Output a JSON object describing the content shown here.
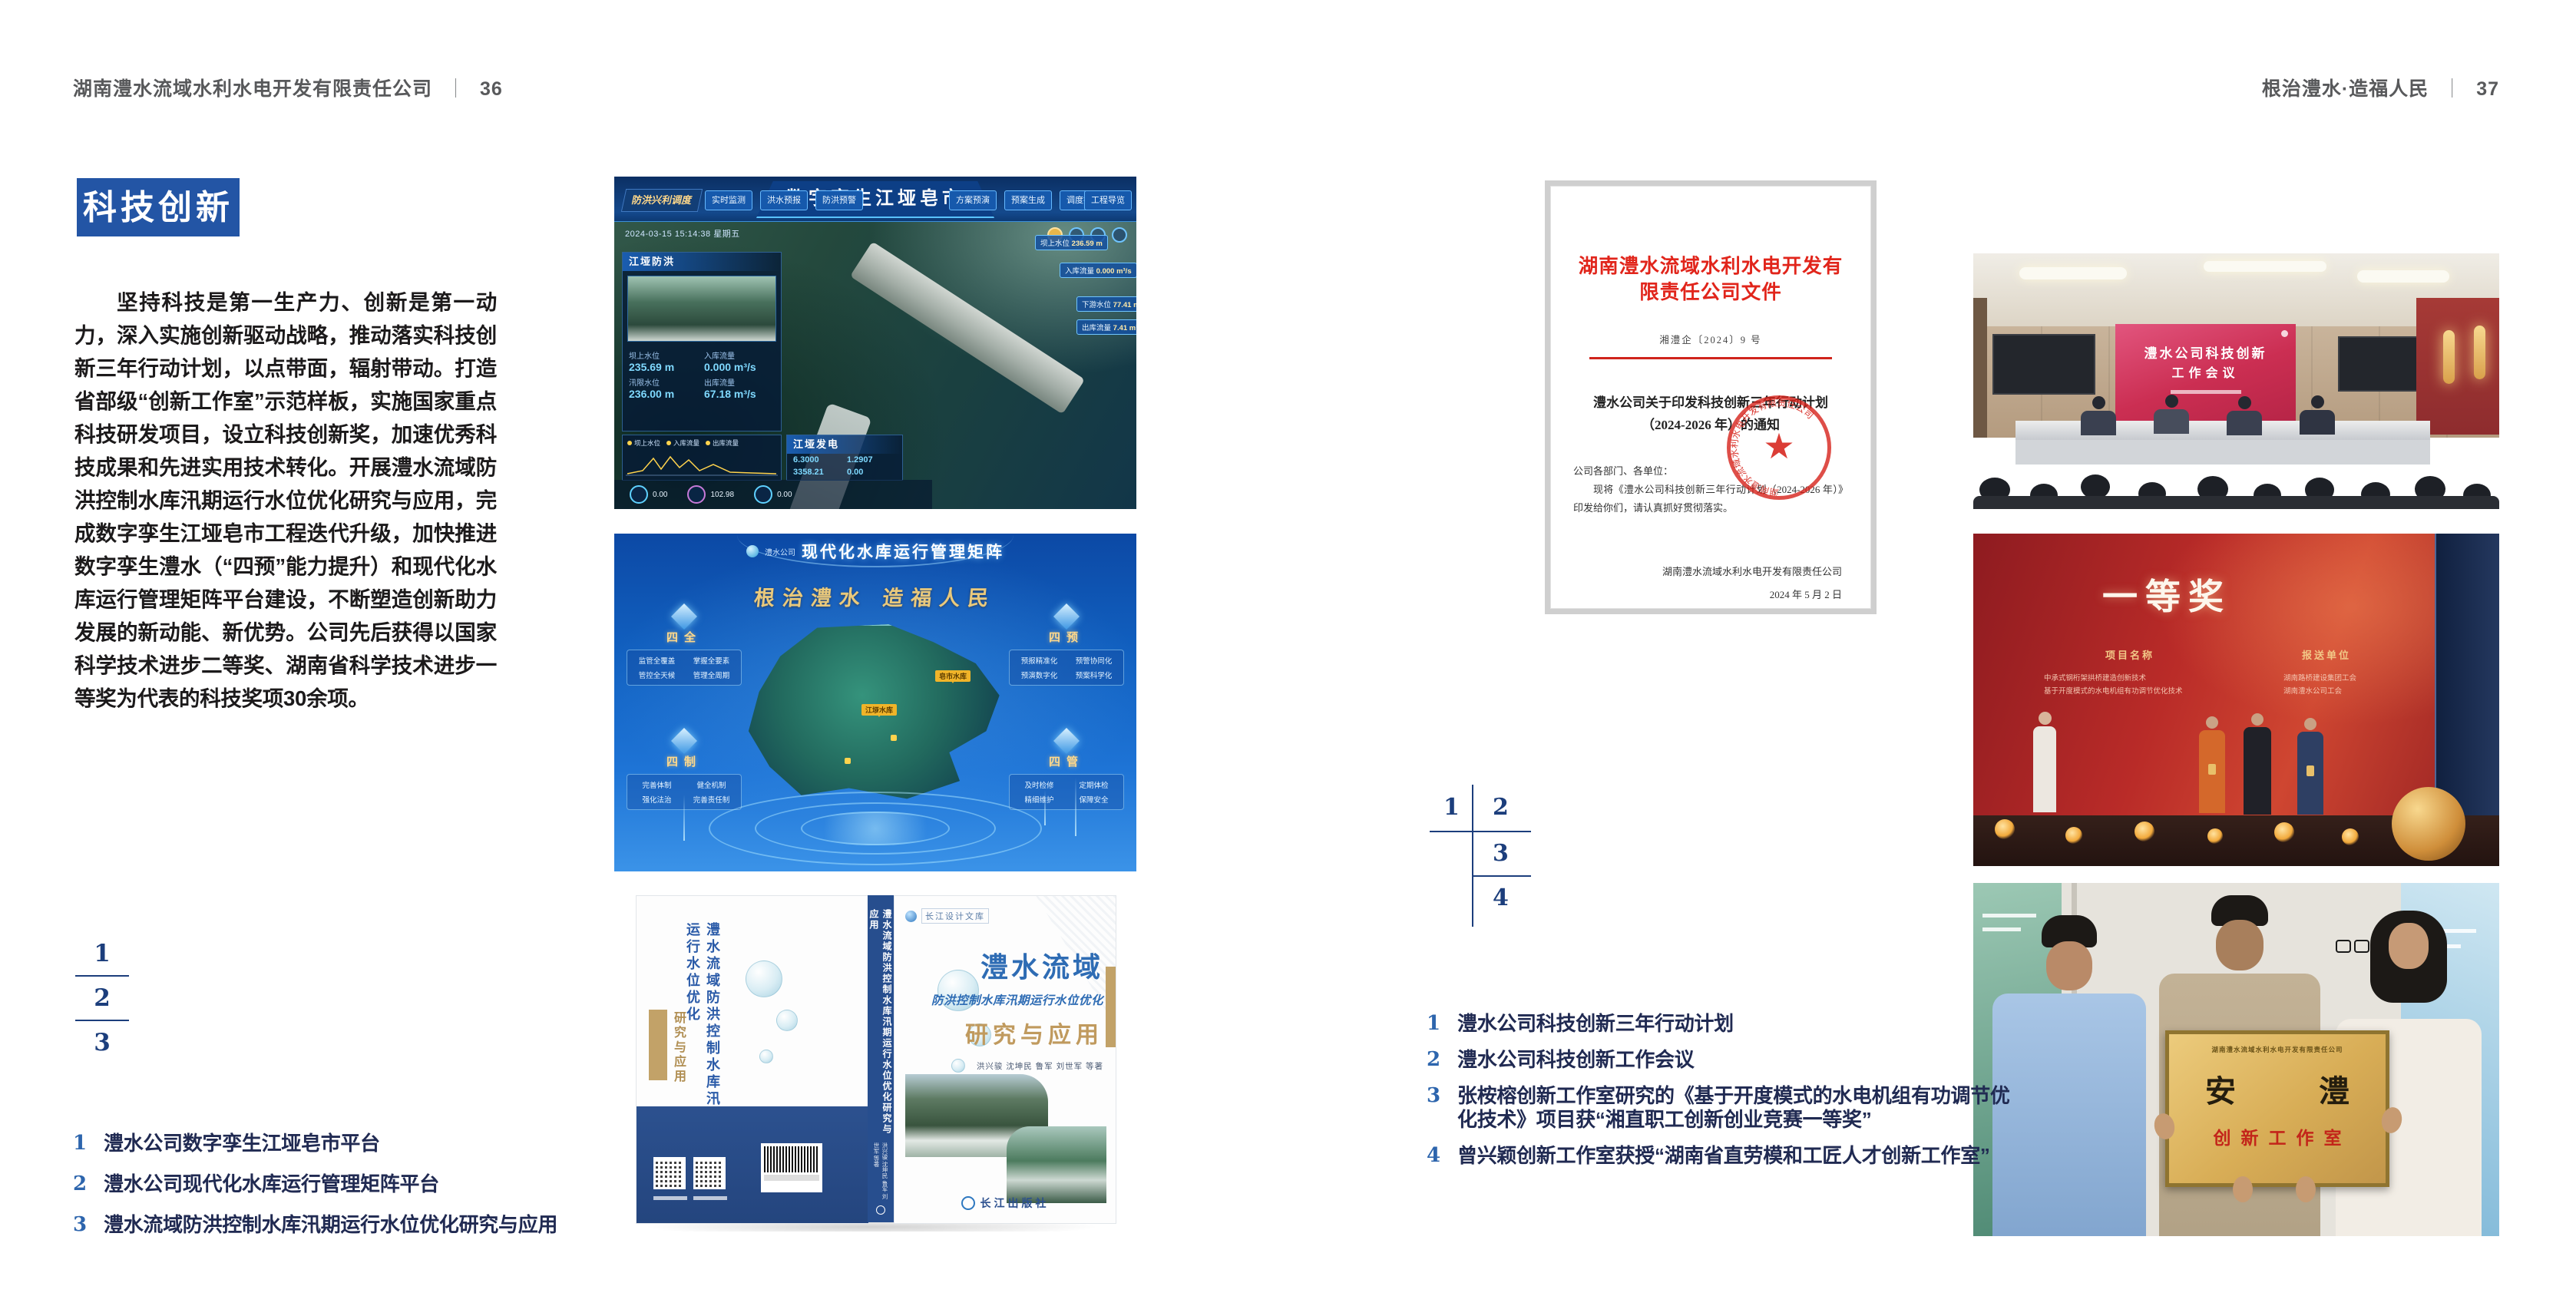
{
  "ui": {
    "separator": "｜"
  },
  "colors": {
    "badge_blue": "#2355a5",
    "figure_number_blue": "#1c3e7c",
    "caption_number_blue": "#2d65ad",
    "caption_text_navy": "#202a52",
    "doc_red": "#e1251b",
    "award_red": "#b92b28",
    "plaque_gold": "#d9b262"
  },
  "icons": {
    "seal_star": "★"
  },
  "page_left": {
    "header": "湖南澧水流域水利水电开发有限责任公司",
    "page_no": "36",
    "section_badge": "科技创新",
    "body": "坚持科技是第一生产力、创新是第一动力，深入实施创新驱动战略，推动落实科技创新三年行动计划，以点带面，辐射带动。打造省部级“创新工作室”示范样板，实施国家重点科技研发项目，设立科技创新奖，加速优秀科技成果和先进实用技术转化。开展澧水流域防洪控制水库汛期运行水位优化研究与应用，完成数字孪生江垭皂市工程迭代升级，加快推进数字孪生澧水（“四预”能力提升）和现代化水库运行管理矩阵平台建设，不断塑造创新助力发展的新动能、新优势。公司先后获得以国家科学技术进步二等奖、湖南省科学技术进步一等奖为代表的科技奖项30余项。",
    "figure_numbers": [
      "1",
      "2",
      "3"
    ],
    "captions": [
      {
        "num": "1",
        "text": "澧水公司数字孪生江垭皂市平台"
      },
      {
        "num": "2",
        "text": "澧水公司现代化水库运行管理矩阵平台"
      },
      {
        "num": "3",
        "text": "澧水流域防洪控制水库汛期运行水位优化研究与应用"
      }
    ]
  },
  "page_right": {
    "header": "根治澧水·造福人民",
    "page_no": "37",
    "figure_numbers": [
      "1",
      "2",
      "3",
      "4"
    ],
    "captions": [
      {
        "num": "1",
        "text": "澧水公司科技创新三年行动计划"
      },
      {
        "num": "2",
        "text": "澧水公司科技创新工作会议"
      },
      {
        "num": "3",
        "text": "张桉榕创新工作室研究的《基于开度模式的水电机组有功调节优化技术》项目获“湘直职工创新创业竞赛一等奖”"
      },
      {
        "num": "4",
        "text": "曾兴颖创新工作室获授“湖南省直劳模和工匠人才创新工作室”"
      }
    ]
  },
  "fig_digital_twin": {
    "title": "数字孪生江垭皂市",
    "tab": "防洪兴利调度",
    "menus_left": [
      "实时监测",
      "洪水预报",
      "防洪预警"
    ],
    "menus_right": [
      "方案预演",
      "预案生成",
      "调度执行",
      "工程导览"
    ],
    "timestamp": "2024-03-15 15:14:38 星期五",
    "panel_flood": {
      "title": "江垭防洪",
      "stats": [
        {
          "label": "坝上水位",
          "value": "235.69 m"
        },
        {
          "label": "入库流量",
          "value": "0.000 m³/s"
        },
        {
          "label": "汛限水位",
          "value": "236.00 m"
        },
        {
          "label": "出库流量",
          "value": "67.18 m³/s"
        }
      ]
    },
    "chart_legend": [
      "坝上水位",
      "入库流量",
      "出库流量"
    ],
    "panel_power": {
      "title": "江垭发电",
      "values": [
        "6.3000",
        "1.2907",
        "3358.21",
        "0.00"
      ]
    },
    "callouts": [
      {
        "label": "坝上水位",
        "value": "236.59 m"
      },
      {
        "label": "入库流量",
        "value": "0.000 m³/s"
      },
      {
        "label": "下游水位",
        "value": "77.41 m"
      },
      {
        "label": "出库流量",
        "value": "7.41 m³/s"
      }
    ],
    "gauge_values": [
      "0.00",
      "102.98",
      "0.00"
    ]
  },
  "fig_matrix": {
    "logo_text": "澧水公司",
    "header": "现代化水库运行管理矩阵",
    "slogan": "根治澧水 造福人民",
    "markers": [
      "皂市水库",
      "江垭水库"
    ],
    "nodes": [
      {
        "title": "四全",
        "items": [
          "监管全覆盖",
          "掌握全要素",
          "管控全天候",
          "管理全周期"
        ]
      },
      {
        "title": "四预",
        "items": [
          "预报精准化",
          "预警协同化",
          "预演数字化",
          "预案科学化"
        ]
      },
      {
        "title": "四制",
        "items": [
          "完善体制",
          "健全机制",
          "强化法治",
          "完善责任制"
        ]
      },
      {
        "title": "四管",
        "items": [
          "及时检修",
          "定期体检",
          "精细维护",
          "保障安全"
        ]
      }
    ]
  },
  "fig_book": {
    "library": "长江设计文库",
    "title_region": "澧水流域",
    "title_sub": "防洪控制水库汛期运行水位优化",
    "title_main": "研究与应用",
    "authors": "洪兴骏 沈坤民 鲁军 刘世军 等著",
    "spine": "澧水流域防洪控制水库汛期运行水位优化研究与应用",
    "spine_authors": "洪兴骏 沈坤民 鲁军 刘世军 等著",
    "back_title": "澧水流域防洪控制水库汛期运行水位优化",
    "back_sub": "研究与应用",
    "publisher": "长江出版社"
  },
  "fig_document": {
    "letterhead": "湖南澧水流域水利水电开发有限责任公司文件",
    "doc_no": "湘澧企〔2024〕9 号",
    "title_line1": "澧水公司关于印发科技创新三年行动计划",
    "title_line2": "（2024-2026 年）的通知",
    "salutation": "公司各部门、各单位：",
    "body": "现将《澧水公司科技创新三年行动计划（2024-2026 年）》印发给你们，请认真抓好贯彻落实。",
    "signer": "湖南澧水流域水利水电开发有限责任公司",
    "date": "2024 年 5 月 2 日"
  },
  "fig_meeting": {
    "screen_line1": "澧水公司科技创新",
    "screen_line2": "工作会议"
  },
  "fig_award": {
    "headline": "一等奖",
    "col1_label": "项目名称",
    "col2_label": "报送单位",
    "col1_rows": [
      "中承式钢桁架拱桥建造创新技术",
      "基于开度模式的水电机组有功调节优化技术"
    ],
    "col2_rows": [
      "湖南路桥建设集团工会",
      "湖南澧水公司工会"
    ]
  },
  "fig_plaque": {
    "org_line": "湖南澧水流域水利水电开发有限责任公司",
    "name": "安　澧",
    "subtitle": "创新工作室"
  }
}
